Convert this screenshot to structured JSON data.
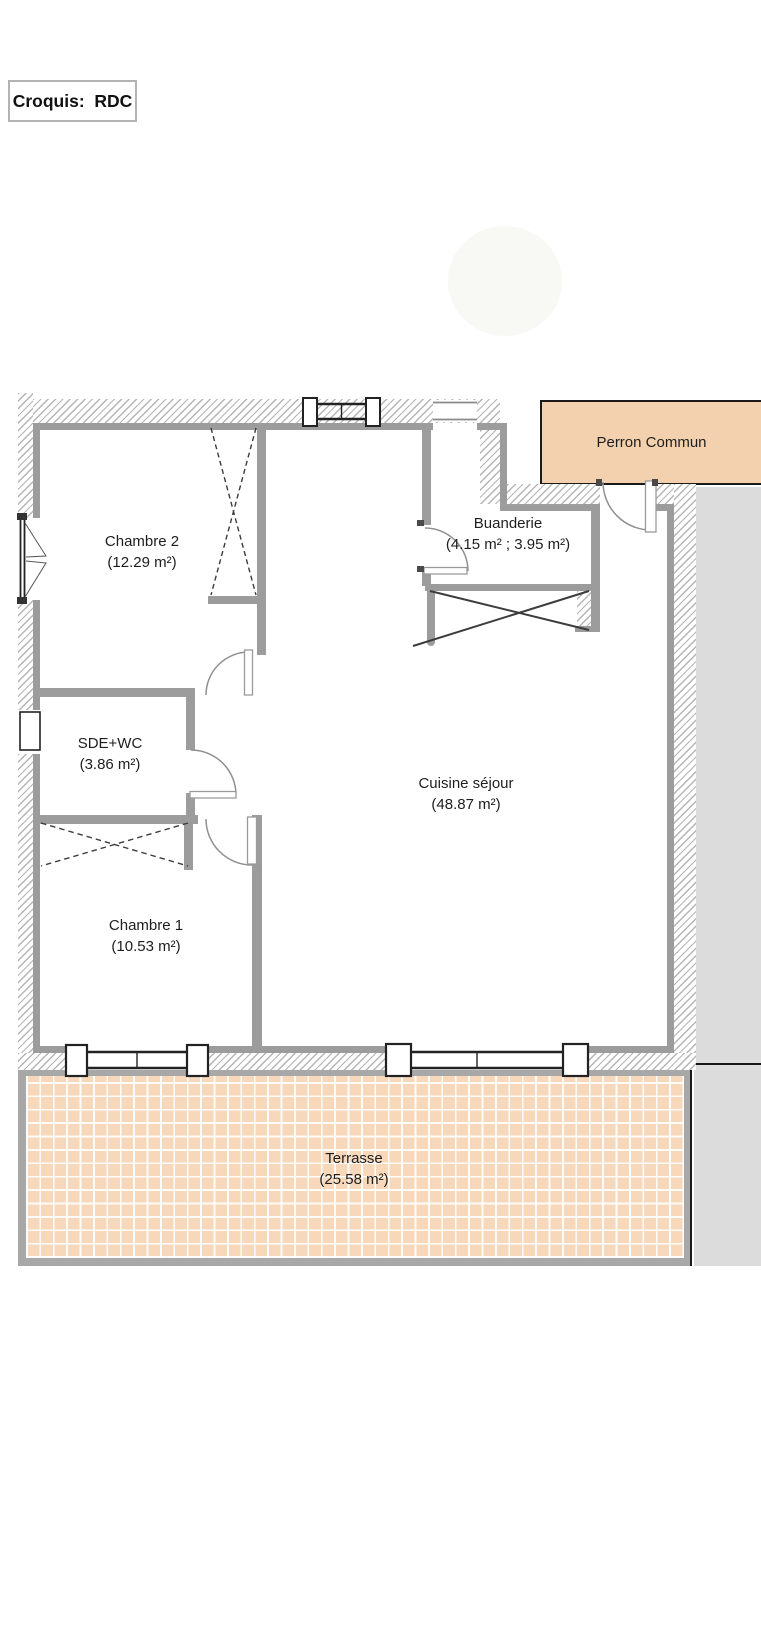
{
  "title": "Croquis:  RDC",
  "rooms": {
    "chambre2": {
      "name": "Chambre 2",
      "area": "(12.29 m²)"
    },
    "buanderie": {
      "name": "Buanderie",
      "area": "(4.15 m² ; 3.95 m²)"
    },
    "sde_wc": {
      "name": "SDE+WC",
      "area": "(3.86 m²)"
    },
    "cuisine": {
      "name": "Cuisine séjour",
      "area": "(48.87 m²)"
    },
    "chambre1": {
      "name": "Chambre 1",
      "area": "(10.53 m²)"
    },
    "terrasse": {
      "name": "Terrasse",
      "area": "(25.58 m²)"
    },
    "perron": {
      "name": "Perron Commun"
    }
  },
  "colors": {
    "perron_fill": "#f4d1ae",
    "terrace_tile": "#f7d8bb",
    "wall_gray": "#9c9c9c",
    "adjacent_gray": "#dcdcdc",
    "hatch_line": "#b5b5b5"
  }
}
